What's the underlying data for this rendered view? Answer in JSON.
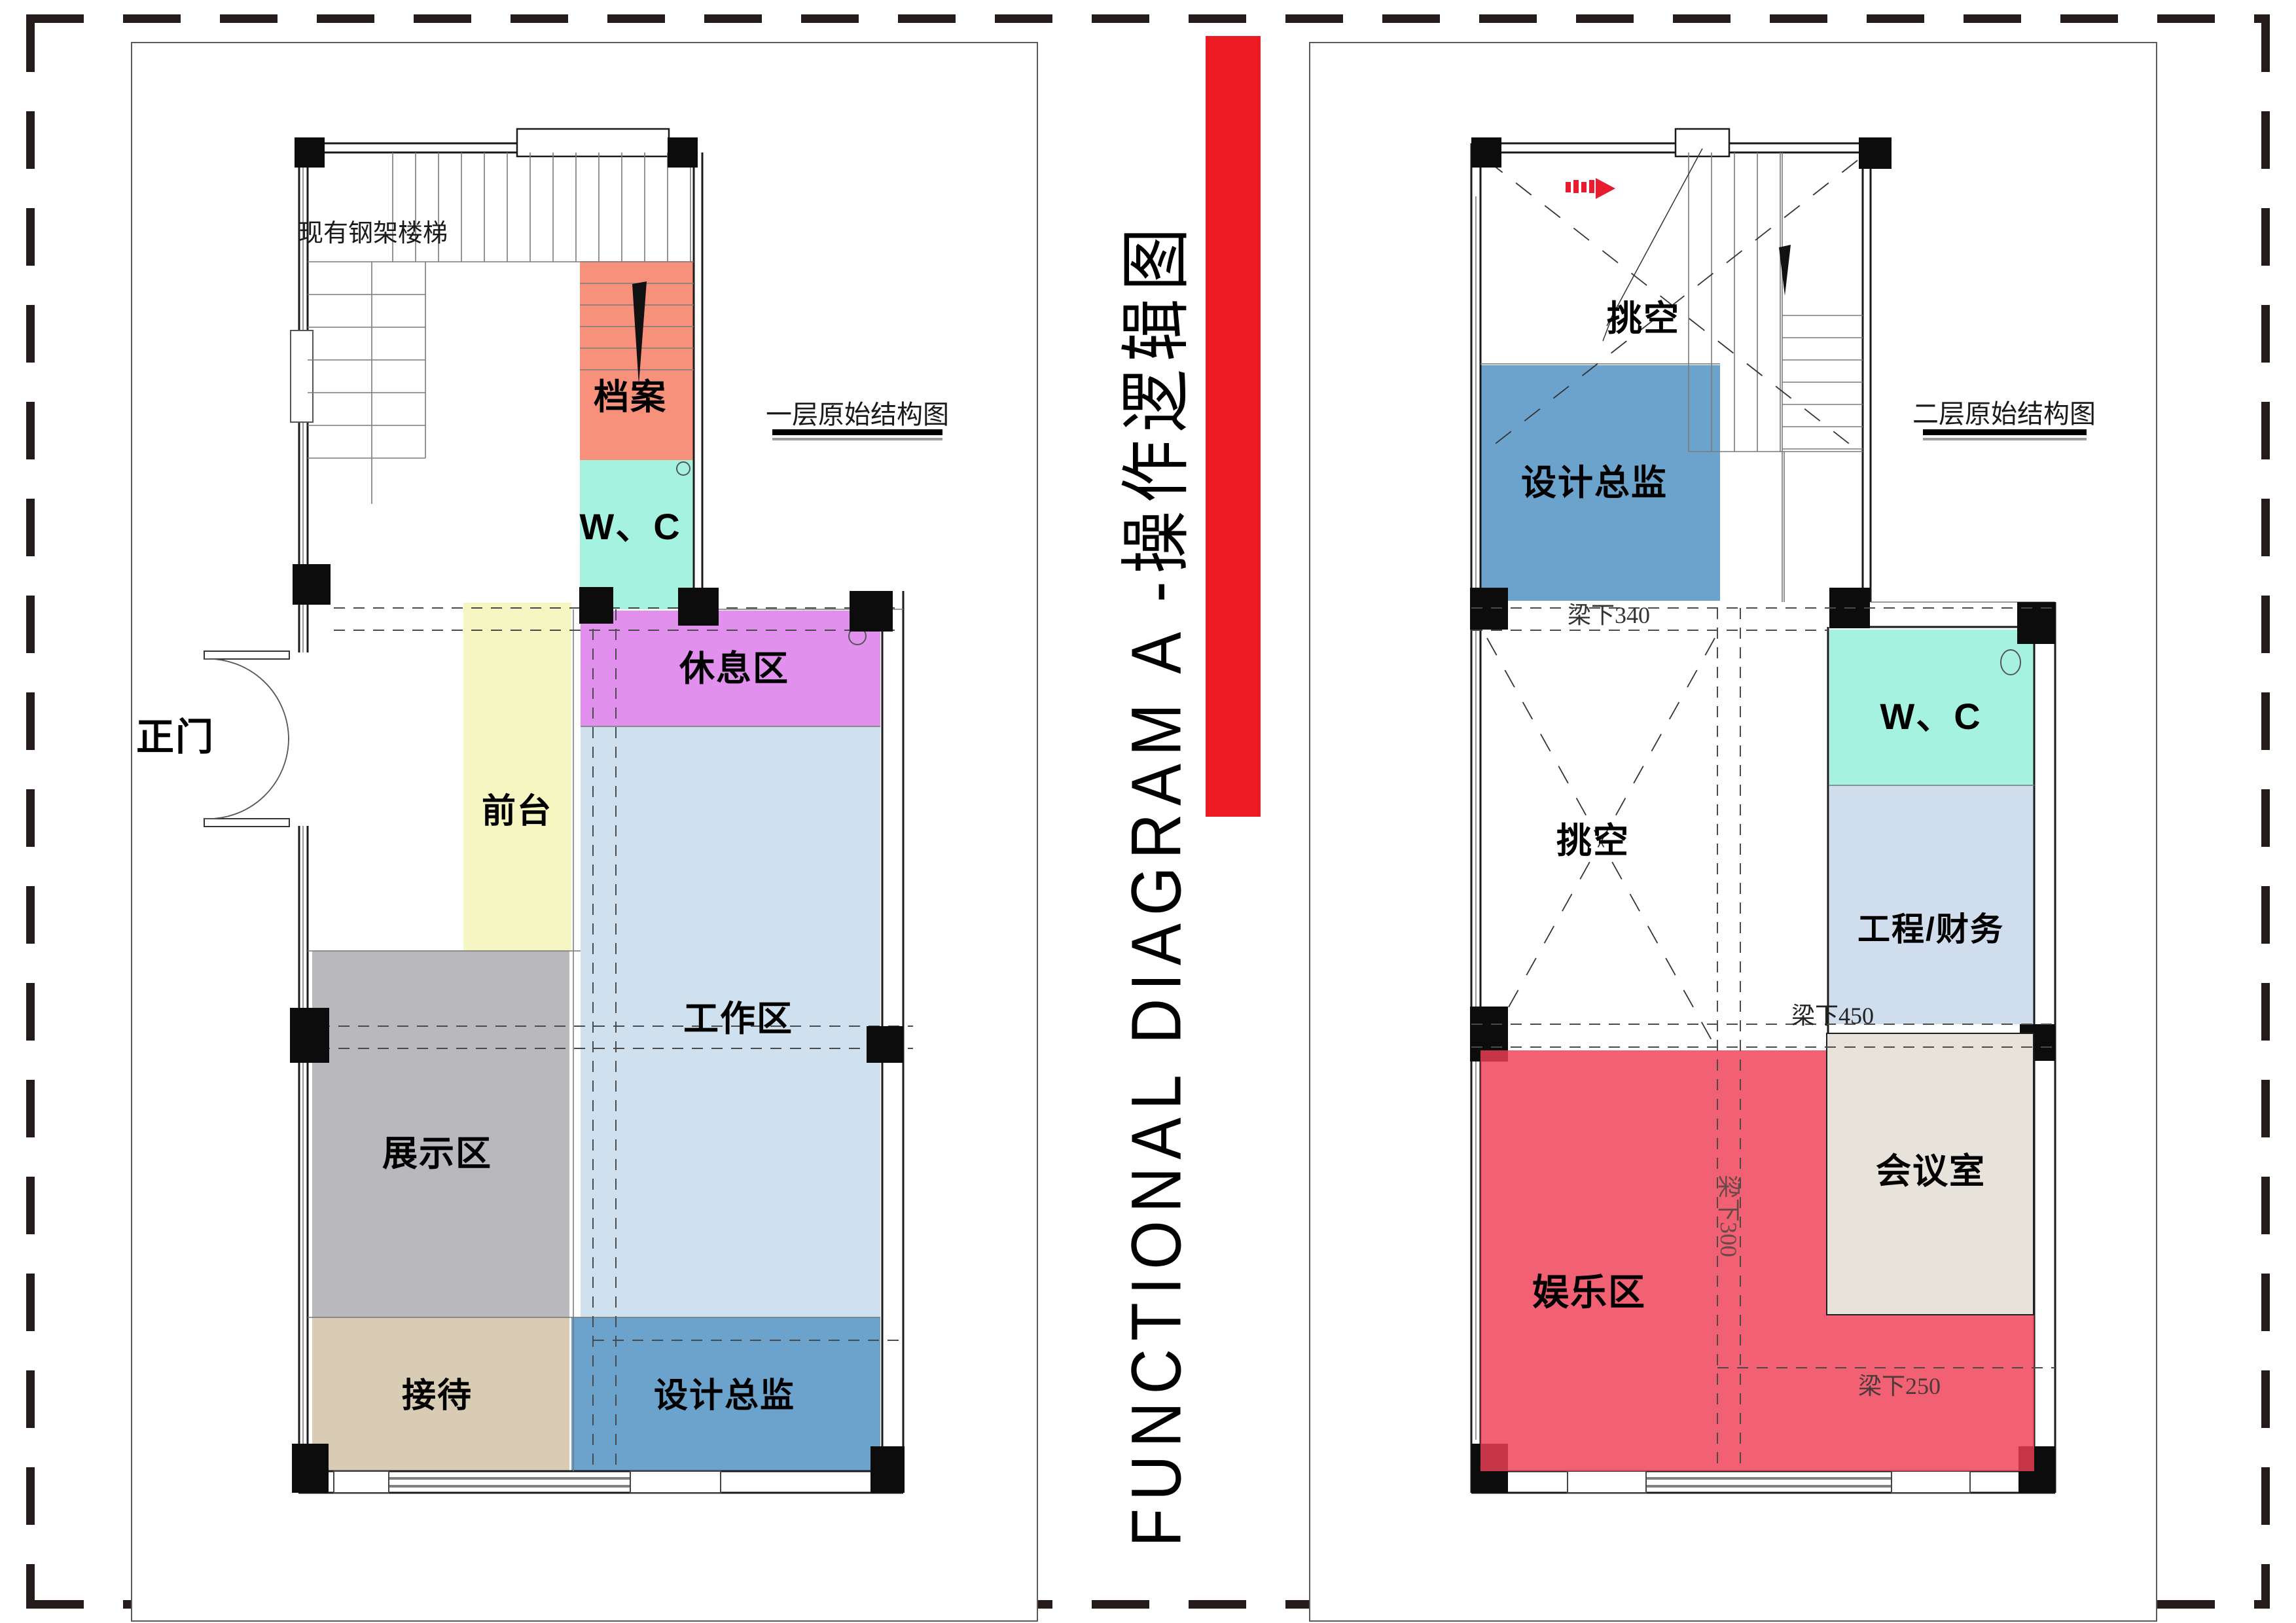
{
  "title": {
    "text": "FUNCTIONAL DIAGRAM A -操作逻辑图",
    "accent_bar_color": "#ed1c24",
    "arrow_color": "#e81c2e"
  },
  "plan1": {
    "caption": "一层原始结构图",
    "stair_note": "现有钢架楼梯",
    "entrance_label": "正门",
    "zones": [
      {
        "id": "archive",
        "label": "档案",
        "color": "#f7917c"
      },
      {
        "id": "wc",
        "label": "W、C",
        "color": "#a5f2e1"
      },
      {
        "id": "reception-desk",
        "label": "前台",
        "color": "#f6f6c2"
      },
      {
        "id": "lounge",
        "label": "休息区",
        "color": "#e190ee"
      },
      {
        "id": "work-area",
        "label": "工作区",
        "color": "#cfe0ee"
      },
      {
        "id": "display-area",
        "label": "展示区",
        "color": "#b9b9bd"
      },
      {
        "id": "greeting",
        "label": "接待",
        "color": "#d8ccb4"
      },
      {
        "id": "design-director",
        "label": "设计总监",
        "color": "#6ba3cd"
      }
    ]
  },
  "plan2": {
    "caption": "二层原始结构图",
    "void_top_label": "挑空",
    "void_mid_label": "挑空",
    "beam_labels": {
      "b340": "梁下340",
      "b450": "梁下450",
      "b300": "梁下300",
      "b250": "梁下250"
    },
    "zones": [
      {
        "id": "design-director-2f",
        "label": "设计总监",
        "color": "#6ba3cd"
      },
      {
        "id": "wc-2f",
        "label": "W、C",
        "color": "#a5f2e1"
      },
      {
        "id": "engineering-finance",
        "label": "工程/财务",
        "color": "#cfdded"
      },
      {
        "id": "meeting-room",
        "label": "会议室",
        "color": "#e8e3da"
      },
      {
        "id": "entertainment",
        "label": "娱乐区",
        "color": "rgba(238,62,84,0.82)"
      }
    ]
  }
}
